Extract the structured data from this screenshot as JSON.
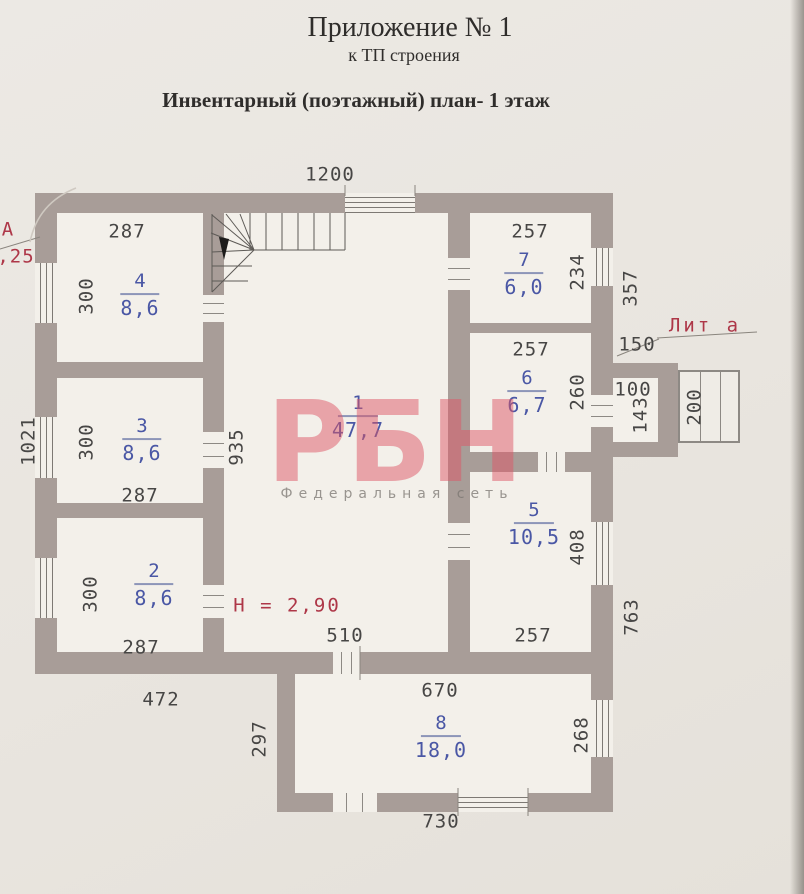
{
  "header": {
    "appendix_title": "Приложение № 1",
    "appendix_subtitle": "к ТП строения",
    "plan_heading": "Инвентарный (поэтажный) план- 1 этаж"
  },
  "watermark": {
    "brand": "РБН",
    "tagline": "Федеральная сеть",
    "brand_color": "#dd5665",
    "tagline_color": "#7a7670"
  },
  "plan": {
    "height_note": "Н = 2,90",
    "building_letter_fragment": "А",
    "dimension_fragment": ",25",
    "annex_label": "Лит а",
    "rooms": [
      {
        "number": "1",
        "area": "47,7",
        "x": 358,
        "y": 418
      },
      {
        "number": "2",
        "area": "8,6",
        "x": 154,
        "y": 586
      },
      {
        "number": "3",
        "area": "8,6",
        "x": 142,
        "y": 441
      },
      {
        "number": "4",
        "area": "8,6",
        "x": 140,
        "y": 296
      },
      {
        "number": "5",
        "area": "10,5",
        "x": 534,
        "y": 525
      },
      {
        "number": "6",
        "area": "6,7",
        "x": 527,
        "y": 393
      },
      {
        "number": "7",
        "area": "6,0",
        "x": 524,
        "y": 275
      },
      {
        "number": "8",
        "area": "18,0",
        "x": 441,
        "y": 738
      }
    ],
    "dims_horizontal": [
      {
        "t": "1200",
        "x": 330,
        "y": 175
      },
      {
        "t": "287",
        "x": 127,
        "y": 232
      },
      {
        "t": "257",
        "x": 530,
        "y": 232
      },
      {
        "t": "150",
        "x": 637,
        "y": 345
      },
      {
        "t": "257",
        "x": 531,
        "y": 350
      },
      {
        "t": "100",
        "x": 633,
        "y": 390
      },
      {
        "t": "287",
        "x": 140,
        "y": 496
      },
      {
        "t": "287",
        "x": 141,
        "y": 648
      },
      {
        "t": "510",
        "x": 345,
        "y": 636
      },
      {
        "t": "257",
        "x": 533,
        "y": 636
      },
      {
        "t": "472",
        "x": 161,
        "y": 700
      },
      {
        "t": "670",
        "x": 440,
        "y": 691
      },
      {
        "t": "730",
        "x": 441,
        "y": 822
      }
    ],
    "dims_vertical": [
      {
        "t": "300",
        "x": 87,
        "y": 296
      },
      {
        "t": "1021",
        "x": 29,
        "y": 441
      },
      {
        "t": "300",
        "x": 87,
        "y": 442
      },
      {
        "t": "935",
        "x": 237,
        "y": 447
      },
      {
        "t": "300",
        "x": 91,
        "y": 594
      },
      {
        "t": "234",
        "x": 578,
        "y": 272
      },
      {
        "t": "357",
        "x": 631,
        "y": 288
      },
      {
        "t": "260",
        "x": 578,
        "y": 392
      },
      {
        "t": "143",
        "x": 641,
        "y": 415
      },
      {
        "t": "200",
        "x": 695,
        "y": 407
      },
      {
        "t": "408",
        "x": 578,
        "y": 547
      },
      {
        "t": "763",
        "x": 632,
        "y": 617
      },
      {
        "t": "268",
        "x": 582,
        "y": 735
      },
      {
        "t": "297",
        "x": 260,
        "y": 739
      }
    ],
    "colors": {
      "wall": "#a89d98",
      "paper": "#e9e6e0",
      "room_fill": "#f3f0ea",
      "room_label_blue": "#4a57a5",
      "annotation_red": "#ae3748"
    }
  }
}
